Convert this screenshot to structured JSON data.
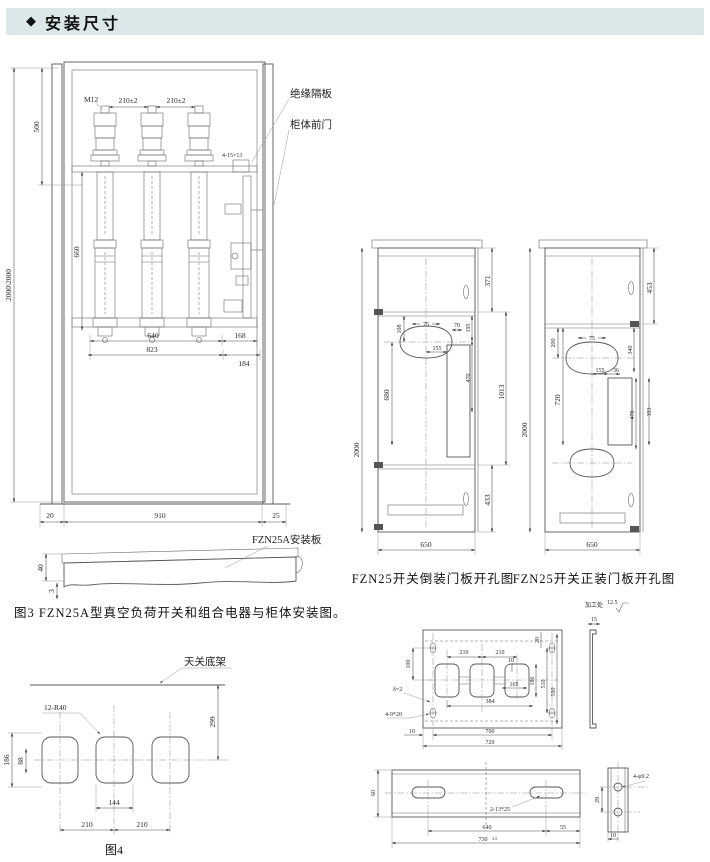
{
  "header": {
    "icon": "◆",
    "title": "安装尺寸"
  },
  "colors": {
    "header_bg": "#dce7ea",
    "line": "#575757",
    "text": "#2b2b2b"
  },
  "cabinet": {
    "insulation_label": "绝缘隔板",
    "front_door_label": "柜体前门",
    "dims": {
      "total_height": "2000\\2000",
      "top_500": "500",
      "bolt": "M12",
      "pitch_left": "210±2",
      "pitch_right": "210±2",
      "pole_660": "660",
      "slot_note": "4-15×13",
      "w640": "640",
      "w168": "168",
      "w823": "823",
      "w184": "184",
      "gap_left": "20",
      "w910": "910",
      "gap_right": "25"
    }
  },
  "mount_plate": {
    "label": "FZN25A安装板",
    "t40": "40",
    "t3": "3"
  },
  "fig3_caption": "图3 FZN25A型真空负荷开关和组合电器与柜体安装图。",
  "panel_inverted": {
    "caption": "FZN25开关倒装门板开孔图",
    "dims": {
      "h2000": "2000",
      "s371": "371",
      "c75": "75",
      "v108": "108",
      "h155": "155",
      "h70": "70",
      "v195": "195",
      "v680": "680",
      "v470": "470",
      "v1013": "1013",
      "s433": "433",
      "w650": "650"
    }
  },
  "panel_normal": {
    "caption": "FZN25开关正装门板开孔图",
    "dims": {
      "h2000": "2000",
      "s453": "453",
      "c75": "75",
      "v200": "200",
      "v340": "340",
      "h155": "155",
      "h36": "36",
      "v720": "720",
      "v470": "470",
      "v393": "393",
      "w650": "650"
    }
  },
  "base_frame": {
    "label": "天关底架",
    "hole_note": "12-R40",
    "caption": "图4",
    "dims": {
      "v299": "299",
      "v186": "186",
      "v88": "88",
      "w144": "144",
      "p210a": "210",
      "p210b": "210"
    }
  },
  "hole_plate": {
    "finish_label": "加工处",
    "finish_value": "12.5",
    "thickness": "δ=2",
    "slot_note": "4-9*20",
    "dims": {
      "v100": "100",
      "p210a": "210",
      "p210b": "210",
      "t10": "10",
      "w165": "165",
      "v186": "186",
      "w384": "384",
      "v510": "510",
      "v590": "590",
      "t20": "20",
      "b10": "10",
      "w700": "700",
      "w720": "720",
      "w15": "15"
    }
  },
  "bar": {
    "slot_note": "2-13*25",
    "hole_note": "4-φ9.2",
    "dims": {
      "v60": "60",
      "w640": "640",
      "w55": "55",
      "w730": "730",
      "tol": "±1",
      "v29": "29",
      "b10": "10"
    }
  }
}
